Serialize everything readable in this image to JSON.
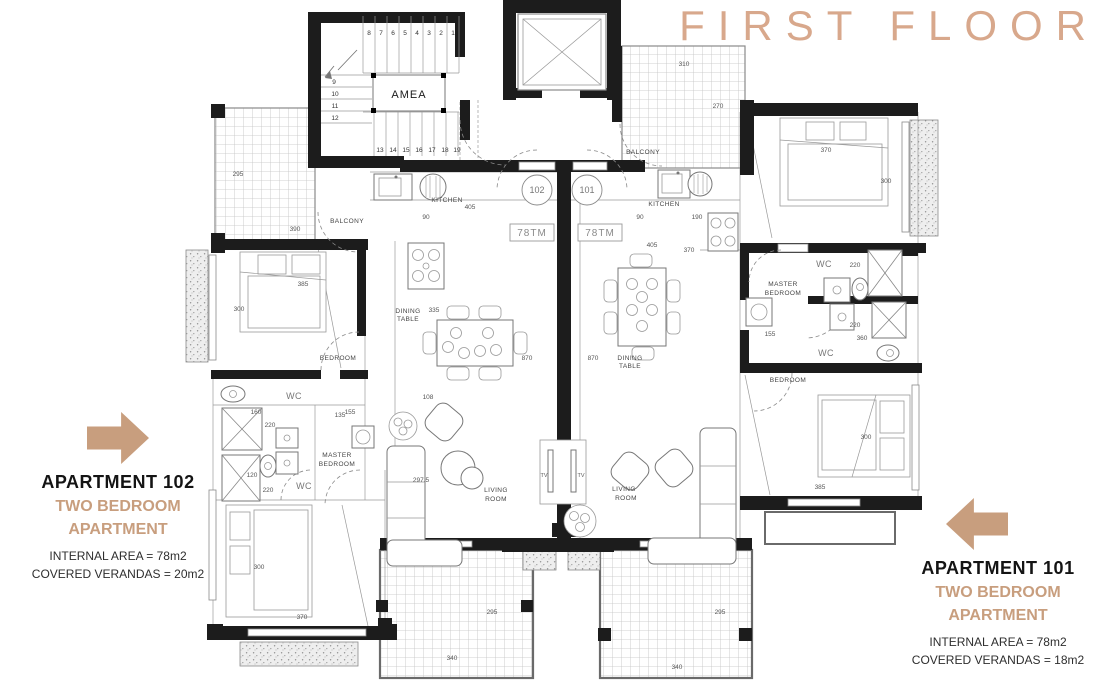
{
  "title": "FIRST FLOOR",
  "colors": {
    "accent": "#c89e7e",
    "title_color": "#d8a88c"
  },
  "apartment102": {
    "name": "APARTMENT 102",
    "type_line1": "TWO BEDROOM",
    "type_line2": "APARTMENT",
    "internal_area": "INTERNAL AREA = 78m2",
    "covered_verandas": "COVERED VERANDAS = 20m2"
  },
  "apartment101": {
    "name": "APARTMENT 101",
    "type_line1": "TWO BEDROOM",
    "type_line2": "APARTMENT",
    "internal_area": "INTERNAL AREA = 78m2",
    "covered_verandas": "COVERED VERANDAS = 18m2"
  },
  "plan": {
    "labels": {
      "amea": "AMEA",
      "kitchen": "KITCHEN",
      "balcony": "BALCONY",
      "wc": "WC",
      "bedroom": "BEDROOM",
      "tv": "TV",
      "master_bedroom": [
        "MASTER",
        "BEDROOM"
      ],
      "living_room": [
        "LIVING",
        "ROOM"
      ],
      "dining_table": [
        "DINING",
        "TABLE"
      ],
      "unit_left": "102",
      "unit_right": "101",
      "area_tag": "78TM"
    },
    "stairs": {
      "top": [
        "8",
        "7",
        "6",
        "5",
        "4",
        "3",
        "2",
        "1"
      ],
      "left": [
        "9",
        "10",
        "11",
        "12"
      ],
      "bottom": [
        "13",
        "14",
        "15",
        "16",
        "17",
        "18",
        "19"
      ]
    },
    "dims": {
      "d405": "405",
      "d90": "90",
      "d190": "190",
      "d370": "370",
      "d335": "335",
      "d870": "870",
      "d300": "300",
      "d385": "385",
      "d155": "155",
      "d160": "160",
      "d220": "220",
      "d120": "120",
      "d135": "135",
      "d360": "360",
      "d310": "310",
      "d270": "270",
      "d295": "295",
      "d390": "390",
      "d340": "340",
      "d297_5": "297.5",
      "d108": "108"
    }
  }
}
